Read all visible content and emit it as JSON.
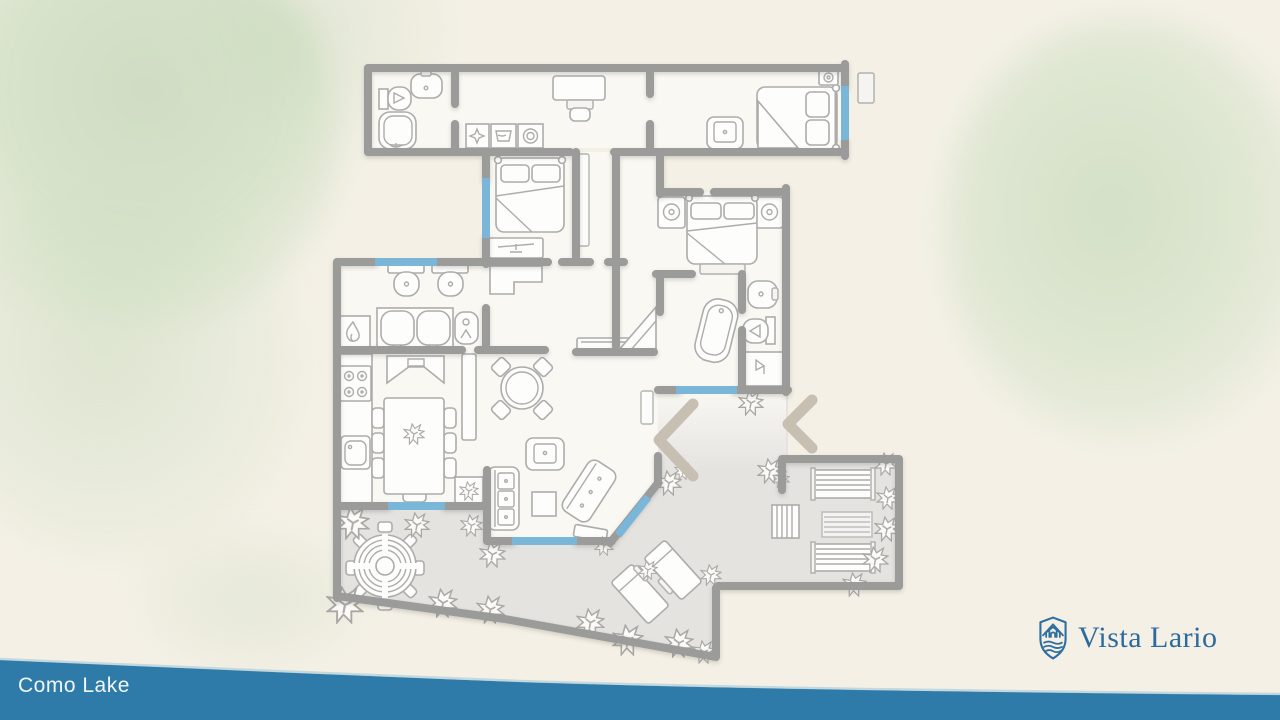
{
  "location_label": "Como Lake",
  "brand": {
    "name": "Vista Lario",
    "logo_icon": "shield-house-waves-icon"
  },
  "colors": {
    "background": "#f4f0e6",
    "walls": "#9b9b99",
    "window_markers": "#7ab6d8",
    "lake_water": "#2e7aa9",
    "brand_blue": "#2c6b9d",
    "terrace_fill": "#e4e3e0",
    "foliage_green": "#c3d8b8",
    "label_text": "#f2f6f8"
  },
  "floor_plan": {
    "type": "residential floor plan, top view",
    "depicted_elements": [
      "double-bed-icon",
      "pillow-icon",
      "nightstand-lamp-icon",
      "armchair-icon",
      "desk-chair-icon",
      "toilet-icon",
      "bidet-icon",
      "sink-icon",
      "double-vanity-icon",
      "bathtub-icon",
      "shower-icon",
      "washer-dryer-icons",
      "fireplace-icon",
      "stove-icon",
      "kitchen-sink-icon",
      "dining-table-icon",
      "round-table-icon",
      "sofa-icon",
      "coffee-table-icon",
      "tv-cabinet-icon",
      "stairs-icon",
      "round-spa-table-icon",
      "sun-lounger-icon",
      "striped-mat-icon",
      "bush-icon",
      "entry-chevron-marks",
      "window-markers",
      "door-leaf"
    ]
  }
}
